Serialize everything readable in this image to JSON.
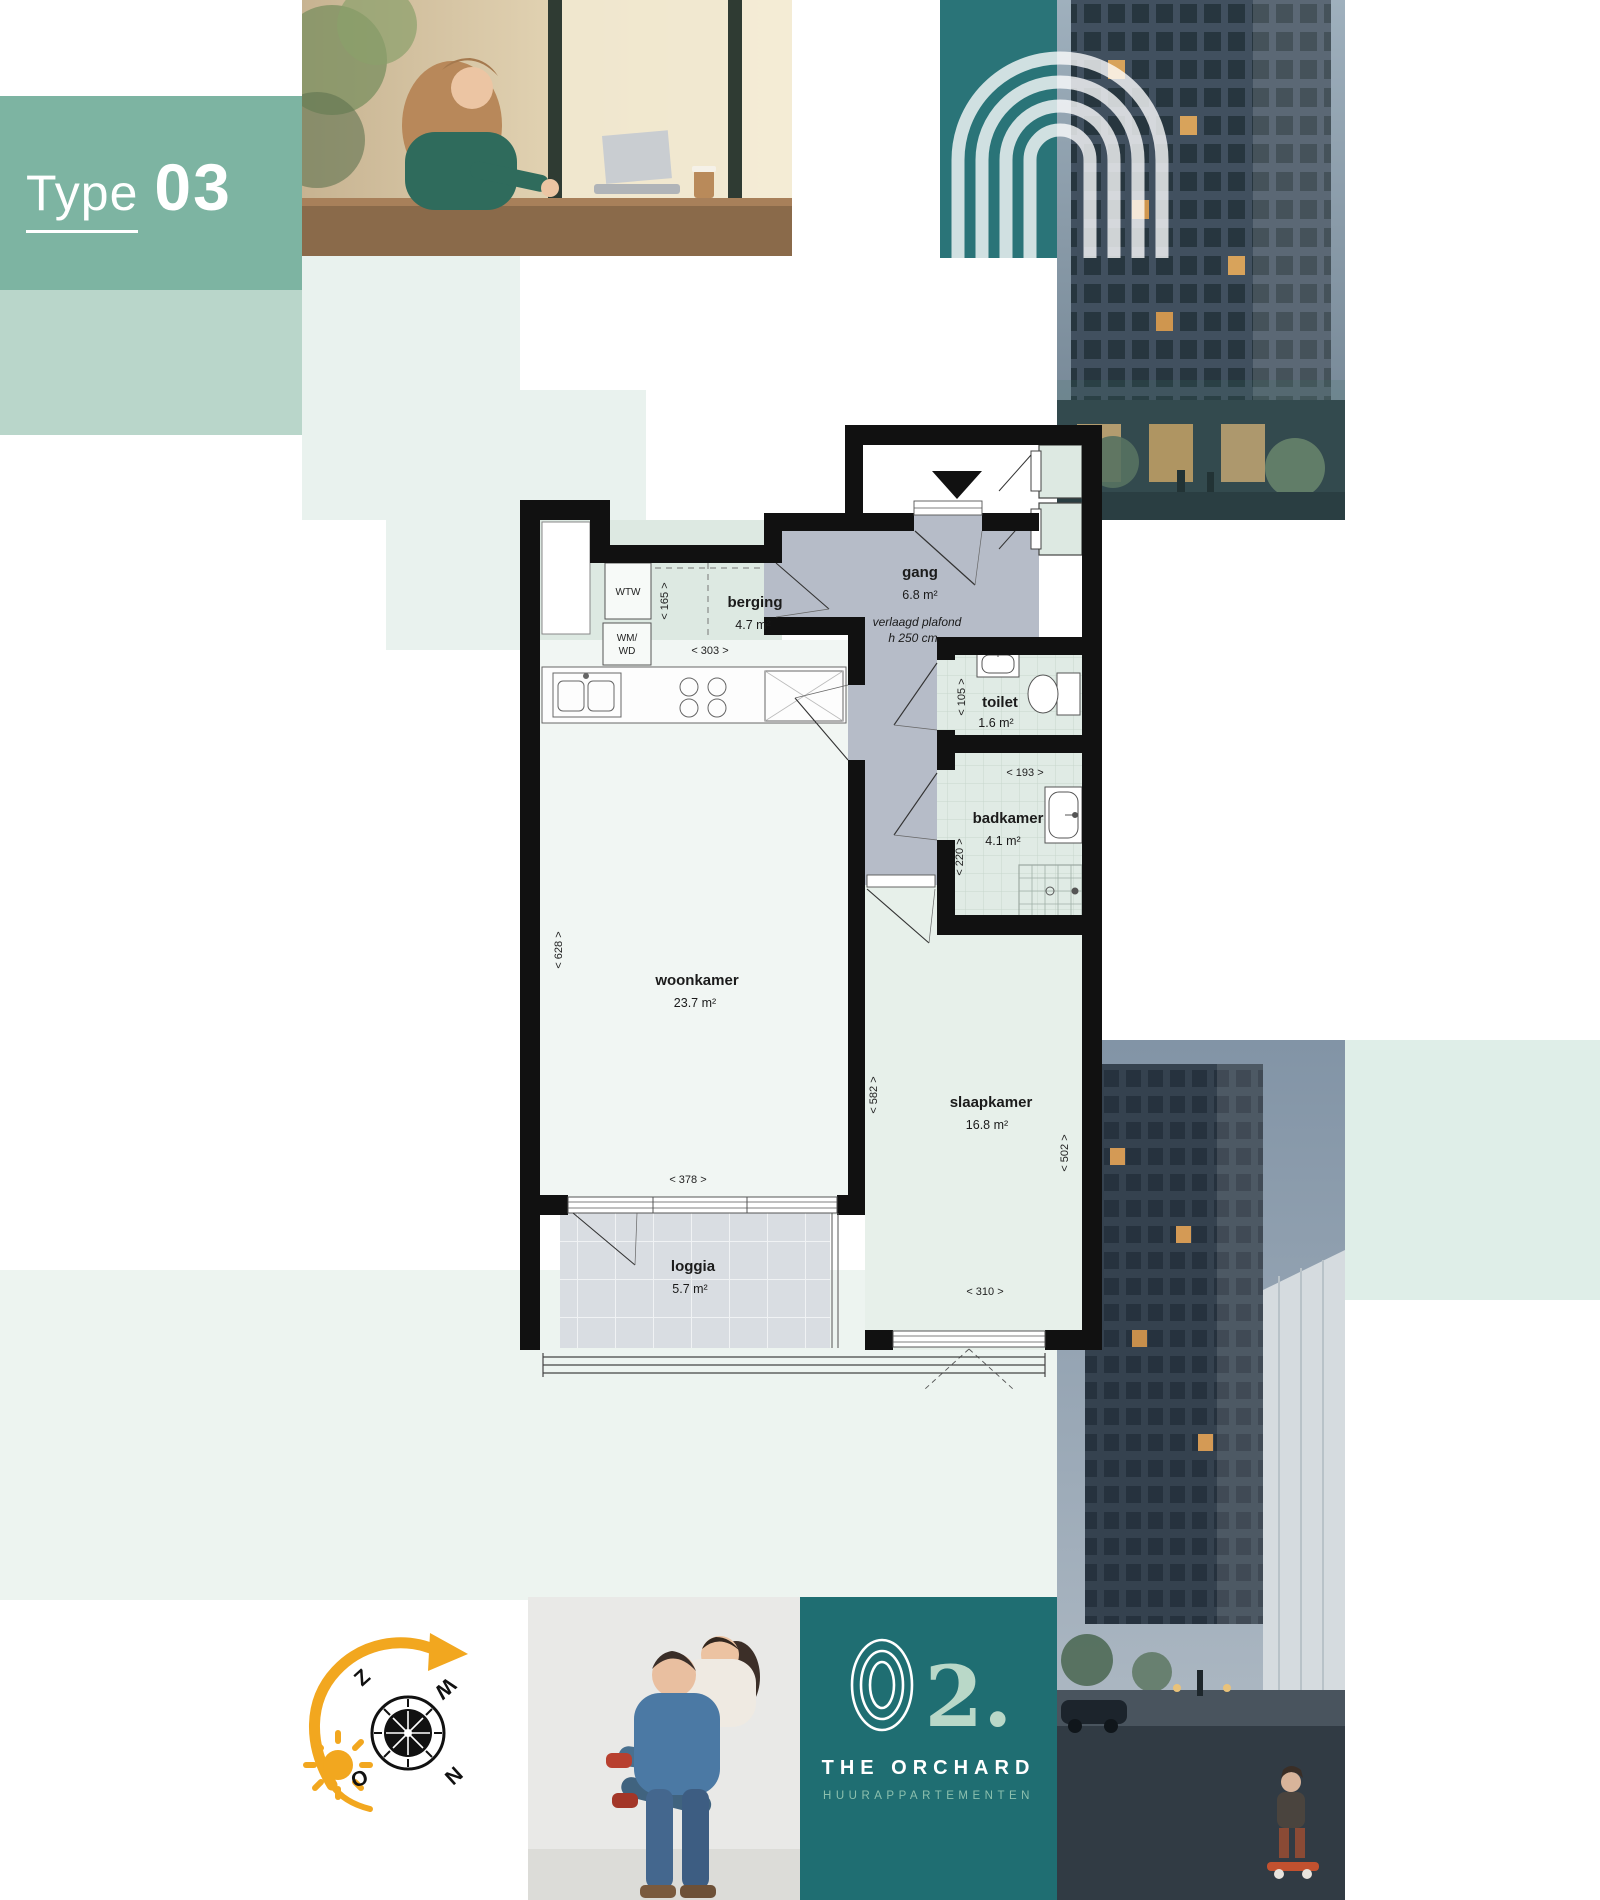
{
  "page": {
    "title_label": "Type",
    "title_number": "03"
  },
  "floorplan": {
    "rooms": {
      "berging": {
        "name": "berging",
        "area": "4.7 m²"
      },
      "gang": {
        "name": "gang",
        "area": "6.8 m²"
      },
      "toilet": {
        "name": "toilet",
        "area": "1.6 m²"
      },
      "badkamer": {
        "name": "badkamer",
        "area": "4.1 m²"
      },
      "woonkamer": {
        "name": "woonkamer",
        "area": "23.7 m²"
      },
      "slaapkamer": {
        "name": "slaapkamer",
        "area": "16.8 m²"
      },
      "loggia": {
        "name": "loggia",
        "area": "5.7 m²"
      }
    },
    "gang_note_line1": "verlaagd plafond",
    "gang_note_line2": "h 250 cm",
    "appliances": {
      "wtw": "WTW",
      "wm": "WM/",
      "wd": "WD"
    },
    "dims": {
      "d165": "< 165 >",
      "d303": "< 303 >",
      "d105": "< 105 >",
      "d193": "< 193 >",
      "d220": "< 220 >",
      "d628": "< 628 >",
      "d378": "< 378 >",
      "d582": "< 582 >",
      "d502": "< 502 >",
      "d310": "< 310 >"
    }
  },
  "compass": {
    "z": "Z",
    "w": "W",
    "n": "N",
    "o": "O"
  },
  "logo": {
    "number": "2.",
    "name": "THE ORCHARD",
    "tagline": "HUURAPPARTEMENTEN"
  },
  "colors": {
    "brand_green": "#7db4a2",
    "mint_mid": "#b9d6ca",
    "mint_light": "#e9f2ee",
    "brand_teal": "#2a7478",
    "logo_teal": "#1f6e72",
    "accent_orange": "#f2a71f",
    "plan_gang_gray": "#b6bcc8",
    "plan_room_mint": "#e0ebe5",
    "plan_loggia_gray": "#d9dde2"
  }
}
